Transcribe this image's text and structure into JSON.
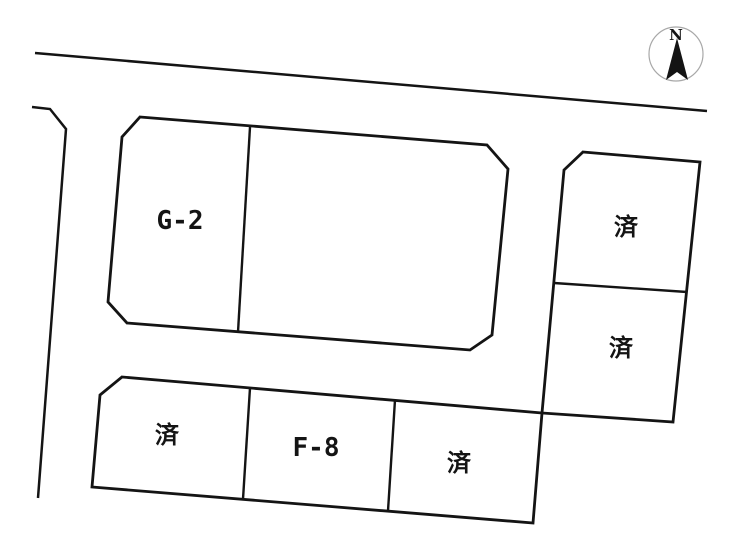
{
  "map": {
    "kind": "land-lot-layout",
    "compass": {
      "north_label": "N"
    },
    "labels": {
      "g2": "G-2",
      "f8": "F-8",
      "sold_right_top": "済",
      "sold_right_bottom": "済",
      "sold_bottom_left": "済",
      "sold_bottom_right": "済"
    },
    "colors": {
      "line": "#141414",
      "background": "#ffffff",
      "compass_circle": "#a8a8a8"
    }
  }
}
